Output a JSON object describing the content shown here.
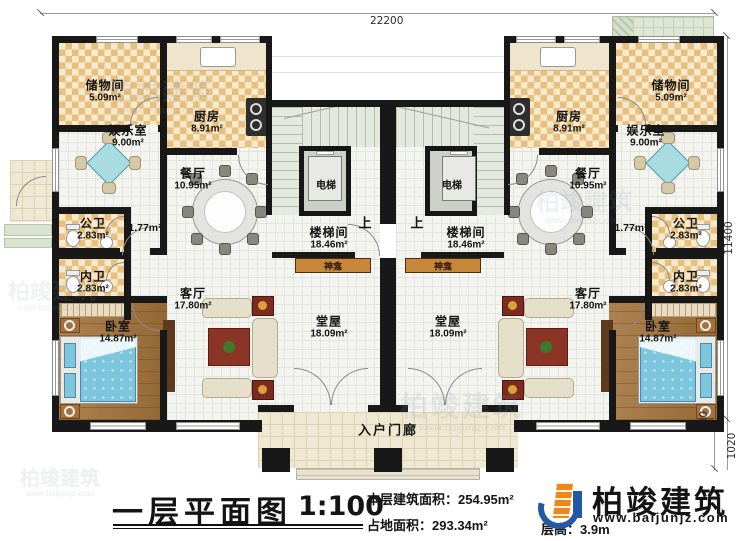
{
  "plan": {
    "dimensions": {
      "top_width": "22200",
      "right_height": "11400",
      "right_lower_step": "800",
      "right_lower_porch": "1020"
    },
    "labels": {
      "elevator": "电梯",
      "up": "上",
      "shrine": "神龛",
      "porch": "入户门廊"
    },
    "rooms": [
      {
        "name": "储物间",
        "area": "5.09m²"
      },
      {
        "name": "厨房",
        "area": "8.91m²"
      },
      {
        "name": "娱乐室",
        "area": "9.00m²"
      },
      {
        "name": "餐厅",
        "area": "10.95m²"
      },
      {
        "name": "公卫",
        "area": "2.83m²"
      },
      {
        "name": "",
        "area": "1.77m²"
      },
      {
        "name": "内卫",
        "area": "2.83m²"
      },
      {
        "name": "卧室",
        "area": "14.87m²"
      },
      {
        "name": "客厅",
        "area": "17.80m²"
      },
      {
        "name": "楼梯间",
        "area": "18.46m²"
      },
      {
        "name": "堂屋",
        "area": "18.09m²"
      },
      {
        "name": "储物间",
        "area": "5.09m²"
      },
      {
        "name": "厨房",
        "area": "8.91m²"
      },
      {
        "name": "娱乐室",
        "area": "9.00m²"
      },
      {
        "name": "餐厅",
        "area": "10.95m²"
      },
      {
        "name": "公卫",
        "area": "2.83m²"
      },
      {
        "name": "",
        "area": "1.77m²"
      },
      {
        "name": "内卫",
        "area": "2.83m²"
      },
      {
        "name": "卧室",
        "area": "14.87m²"
      },
      {
        "name": "客厅",
        "area": "17.80m²"
      },
      {
        "name": "楼梯间",
        "area": "18.46m²"
      },
      {
        "name": "堂屋",
        "area": "18.09m²"
      }
    ]
  },
  "title_block": {
    "plan_name": "一层平面图",
    "scale": "1:100",
    "floor_area_label": "本层建筑面积：",
    "floor_area_value": "254.95m²",
    "site_area_label": "占地面积：",
    "site_area_value": "293.34m²",
    "floor_height_label": "层高：",
    "floor_height_value": "3.9m"
  },
  "brand": {
    "company": "柏竣建筑",
    "website": "www.baijunjz.com"
  },
  "watermark": {
    "text": "柏竣建筑",
    "subtext": "www.baijunjz.com"
  },
  "colors": {
    "wall": "#181818",
    "checker": "#e7bf7e",
    "wood": "#a5743c",
    "bed": "#7cc6de",
    "shrine": "#c8883c",
    "logo_blue": "#2458a6",
    "logo_orange": "#ef8718"
  }
}
